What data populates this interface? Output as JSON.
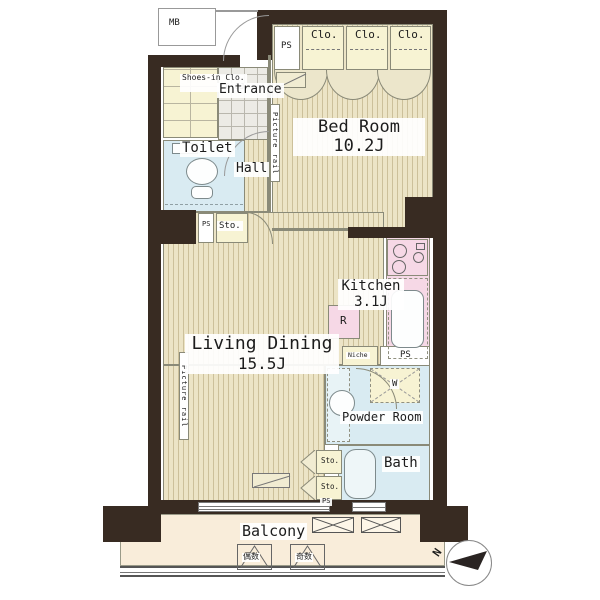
{
  "colors": {
    "wall": "#382b22",
    "floor": "#ece4c6",
    "floor_line": "#ccc09a",
    "closet": "#f7f3d3",
    "water_blue": "#d9ebf2",
    "counter_pink": "#f6d8e6",
    "balcony": "#f9edda",
    "outline": "#8a8a78"
  },
  "labels": {
    "mb": "MB",
    "ps_top": "PS",
    "closets": [
      "Clo.",
      "Clo.",
      "Clo."
    ],
    "shoes_closet": {
      "name": "Shoes-in Clo.",
      "size": "0.8J"
    },
    "entrance": "Entrance",
    "toilet": "Toilet",
    "hall": "Hall",
    "picture_rail_bedroom": "Picture rail",
    "picture_rail_living": "Picture rail",
    "bedroom": {
      "name": "Bed Room",
      "size": "10.2J"
    },
    "living": {
      "name": "Living Dining",
      "size": "15.5J"
    },
    "kitchen": {
      "name": "Kitchen",
      "size": "3.1J"
    },
    "refrigerator": "R",
    "niche": "Niche",
    "ps_kitchen": "PS",
    "washer": "W",
    "ps_hall": "PS",
    "sto_hall": "Sto.",
    "powder_room": "Powder Room",
    "bath": "Bath",
    "sto_upper": "Sto.",
    "sto_lower": "Sto.",
    "ps_bath": "PS",
    "balcony": "Balcony",
    "hatch_left": "偶数",
    "hatch_right": "奇数",
    "compass_north": "N"
  }
}
